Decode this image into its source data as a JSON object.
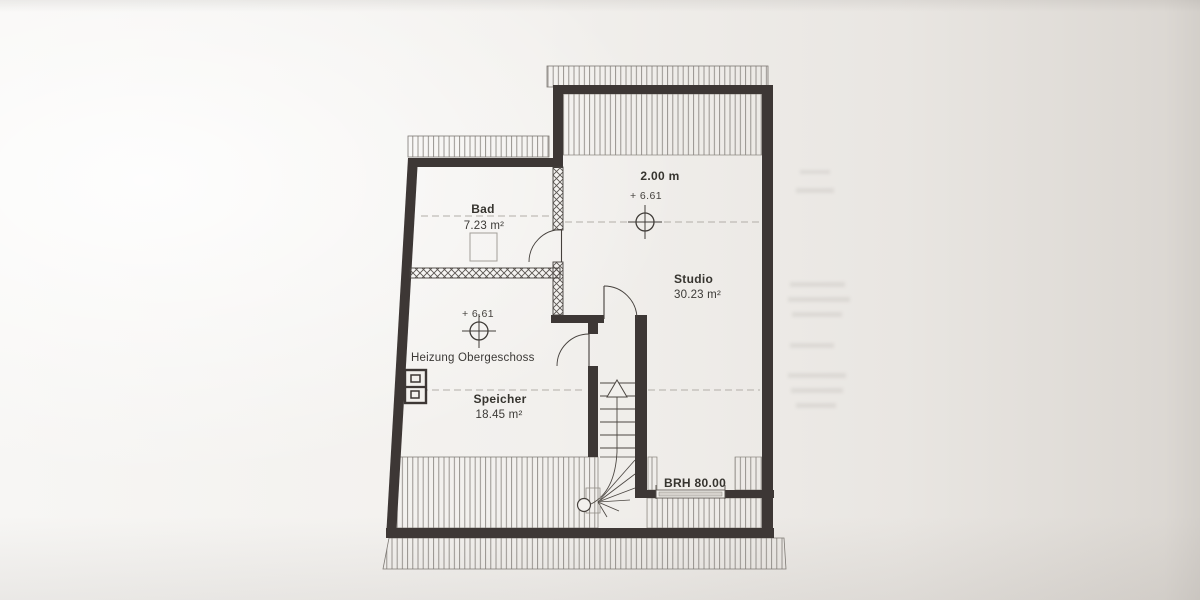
{
  "plan": {
    "rooms": {
      "bad": {
        "name": "Bad",
        "area": "7.23 m²"
      },
      "studio": {
        "name": "Studio",
        "area": "30.23 m²"
      },
      "speicher": {
        "name": "Speicher",
        "area": "18.45 m²"
      }
    },
    "annotations": {
      "heizung": "Heizung Obergeschoss",
      "ceiling_height": "2.00 m",
      "level_studio": "+ 6.61",
      "level_speicher": "+ 6.61",
      "window_sill_height": "BRH 80.00"
    },
    "symbols": {
      "level_marker": "surveyor-crosshair",
      "stair_direction": "up-arrow",
      "roof_area_hatch": "vertical-line-hatch",
      "light_partition_hatch": "cross-hatch"
    },
    "colors": {
      "paper": "#f1efec",
      "wall": "#3d3735",
      "line": "#55504b",
      "dashed_line": "#b2aea8",
      "text": "#3b3936"
    }
  }
}
